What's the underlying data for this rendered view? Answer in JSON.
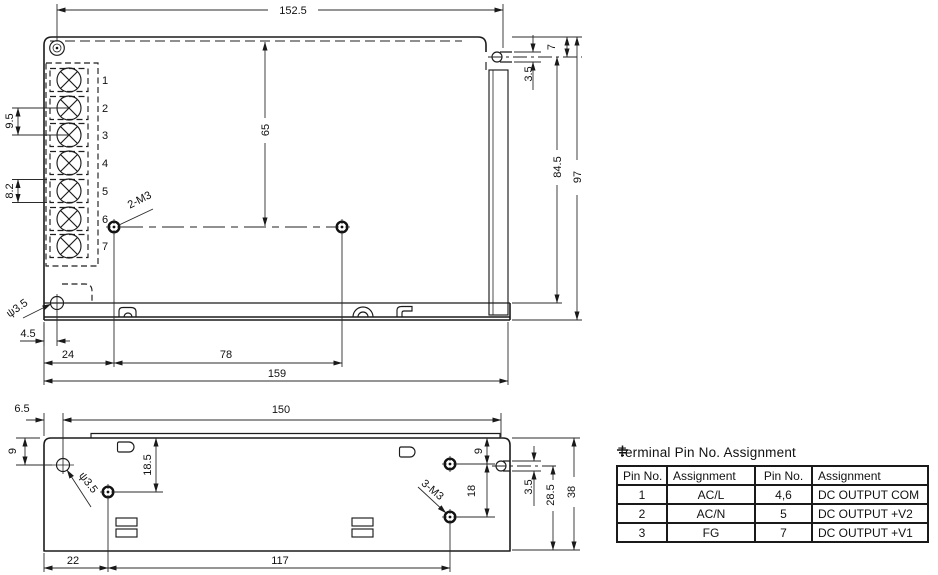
{
  "drawing": {
    "background": "#ffffff",
    "line_color": "#1a1a1a",
    "views": {
      "top": {
        "dims": {
          "width_top": "152.5",
          "height_inner": "65",
          "terminal_pitch": "9.5",
          "terminal_width": "8.2",
          "slot_offset": "7",
          "slot_width": "3.5",
          "slot_to_base": "84.5",
          "height_total": "97",
          "hole_offset": "4.5",
          "screw_left": "24",
          "screw_span": "78",
          "width_total": "159"
        },
        "labels": {
          "screws": "2-M3",
          "hole_dia": "ψ3.5"
        },
        "terminals": [
          "1",
          "2",
          "3",
          "4",
          "5",
          "6",
          "7"
        ]
      },
      "side": {
        "dims": {
          "lip_offset": "6.5",
          "lip_width": "150",
          "hole_top": "9",
          "screw_top": "18.5",
          "screw_right_top": "9",
          "screw_right_span": "18",
          "slot_width": "3.5",
          "slot_to_base": "28.5",
          "height_total": "38",
          "screw_left": "22",
          "screw_span": "117"
        },
        "labels": {
          "screws": "3-M3",
          "hole_dia": "ψ3.5"
        }
      }
    },
    "pin_table": {
      "title": "Terminal Pin No. Assignment",
      "headers": [
        "Pin No.",
        "Assignment",
        "Pin No.",
        "Assignment"
      ],
      "rows": [
        [
          "1",
          "AC/L",
          "4,6",
          "DC OUTPUT COM"
        ],
        [
          "2",
          "AC/N",
          "5",
          "DC OUTPUT +V2"
        ],
        [
          "3",
          "FG",
          "7",
          "DC OUTPUT +V1"
        ]
      ]
    }
  }
}
